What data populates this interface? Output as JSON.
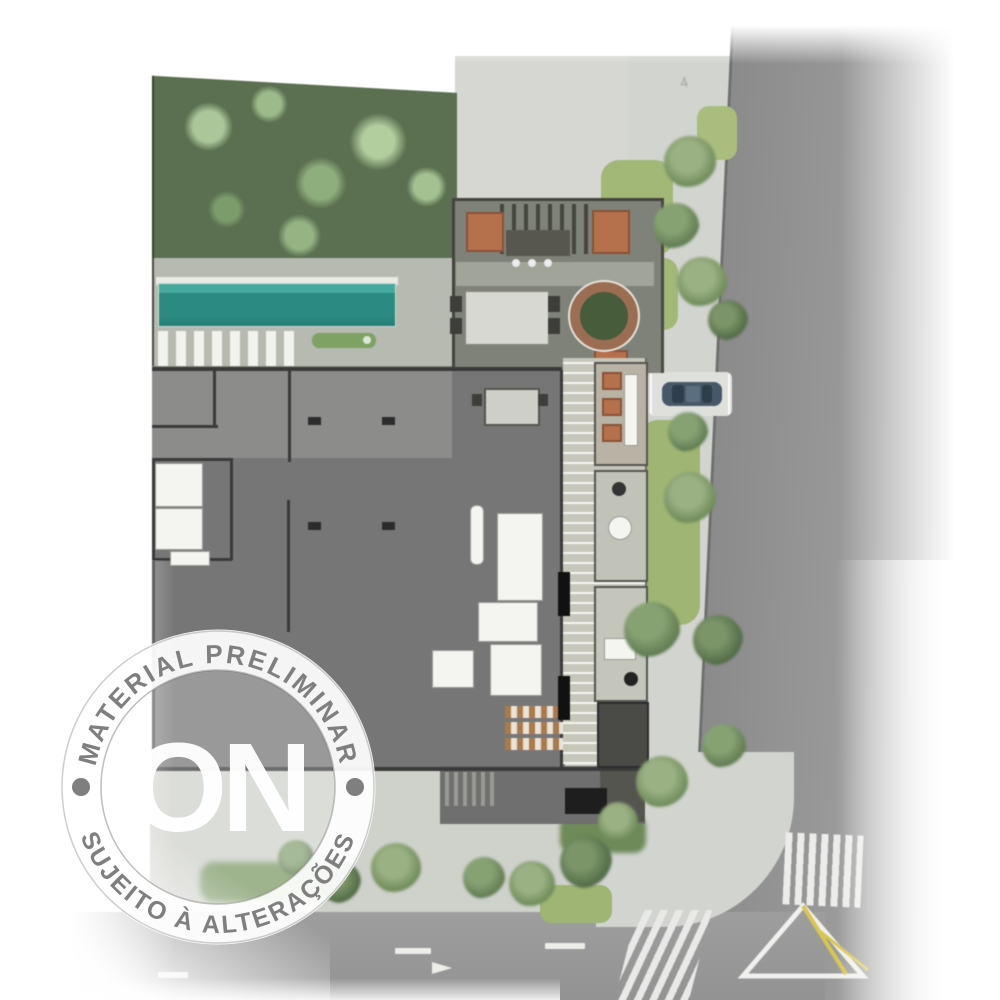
{
  "stamp": {
    "top_text": "MATERIAL PRELIMINAR",
    "bottom_text": "SUJEITO À ALTERAÇÕES",
    "logo_text": "ON"
  },
  "marks": {
    "faint_street_mark": "4"
  },
  "palette": {
    "garden_green": "#5b7050",
    "tree_light": "#abc79a",
    "pool_teal": "#2b8b82",
    "pool_deck": "#b6bab0",
    "building_floor": "#767676",
    "wall_dark": "#3a3a3a",
    "terrace_gray": "#7f8278",
    "boardwalk": "#c6c7ba",
    "sidewalk": "#d2d4cf",
    "lawn_green": "#a2b877",
    "road_gray": "#919191",
    "marking_white": "#ececea",
    "marking_yellow": "#d9c64e",
    "car_body": "#475969",
    "furniture_orange": "#b5714c",
    "stamp_text_gray": "#7f7f7f",
    "stamp_ring_white": "#ffffff"
  }
}
